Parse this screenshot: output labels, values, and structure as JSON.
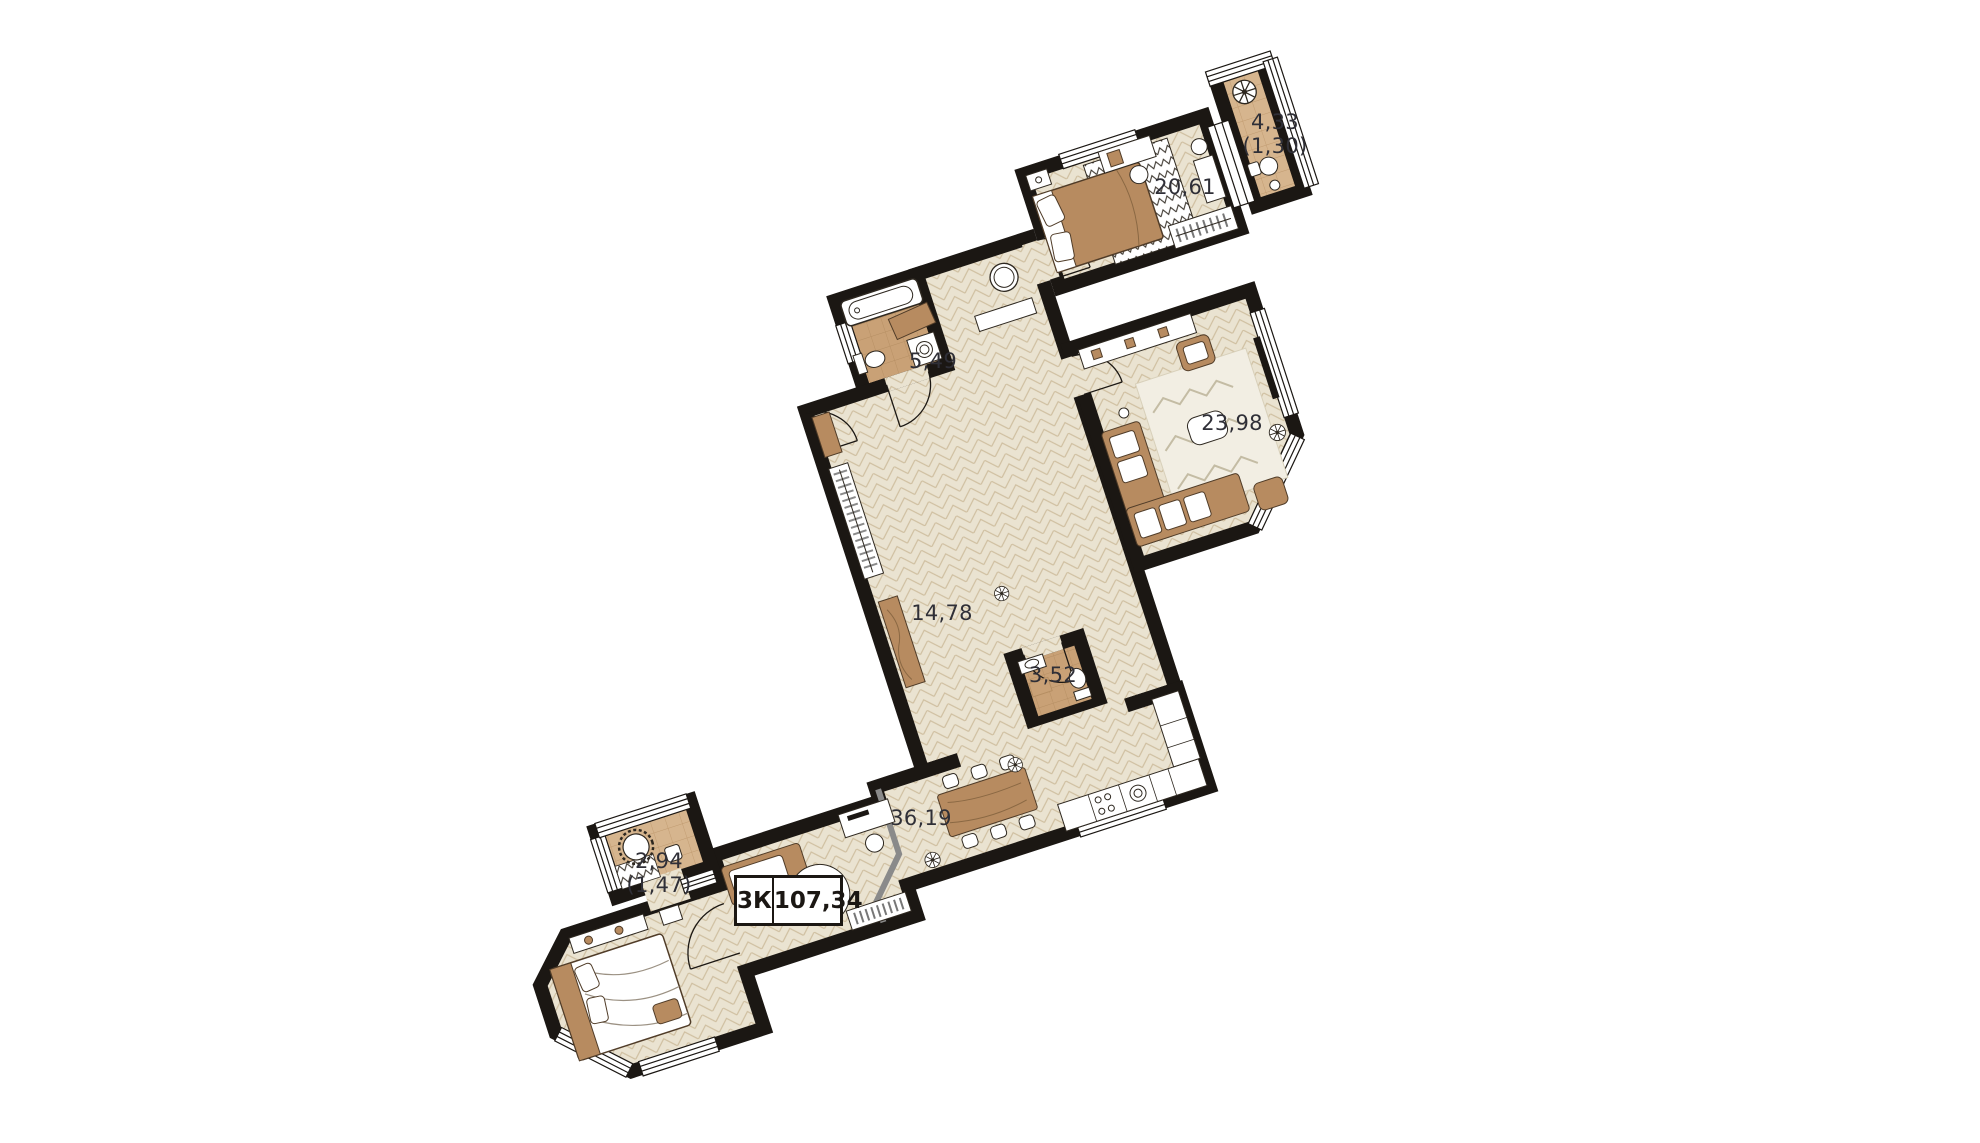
{
  "plan": {
    "title": "Apartment floor plan",
    "type_label": "3К",
    "total_area": "107,34",
    "rooms": [
      {
        "id": "bedroom-top",
        "area": "20,61"
      },
      {
        "id": "balcony-top",
        "area": "4,33",
        "reduced_area": "(1,30)"
      },
      {
        "id": "bathroom",
        "area": "5,49"
      },
      {
        "id": "living-room",
        "area": "23,98"
      },
      {
        "id": "hallway",
        "area": "14,78"
      },
      {
        "id": "wc",
        "area": "3,52"
      },
      {
        "id": "kitchen-living",
        "area": "36,19"
      },
      {
        "id": "balcony-bottom",
        "area": "2,94",
        "reduced_area": "(1,47)"
      }
    ],
    "colors": {
      "wall": "#1b1713",
      "floor": "#eae3d1",
      "floor_line": "#cfbfa0",
      "tile": "#c9a176",
      "tile_line": "#b58e62",
      "balcony_tile": "#d6b58e",
      "balcony_tile_line": "#c09a6f",
      "wood": "#b78b60",
      "wood_dark": "#503c28",
      "accent_gray": "#8a8a8a",
      "label_text": "#2f2f37"
    }
  }
}
